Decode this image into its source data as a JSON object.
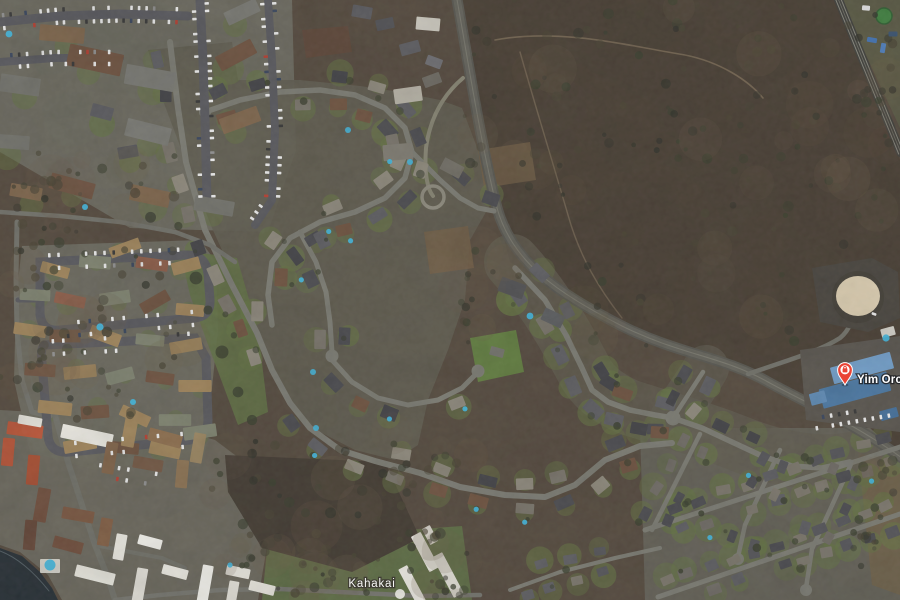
{
  "map": {
    "view_type": "satellite",
    "labels": [
      {
        "id": "road-label",
        "kind": "road",
        "text": "Kahakai"
      },
      {
        "id": "poi-label",
        "kind": "poi",
        "text": "Yim Orch"
      }
    ],
    "poi_pin": {
      "color": "#EA4335",
      "category_icon": "shopping-bag"
    },
    "colors": {
      "scrub_base": "#51463a",
      "scrub_dark": "#453b30",
      "scrub_south": "#3f372e",
      "residential_base": "#5c594c",
      "complex_base": "#67655a",
      "grid_base": "#5f5c52",
      "green_strip": "#5c6b40",
      "green_south": "#5a6941",
      "lawn": "#61713f",
      "field": "#6a5d46",
      "ocean": "#232b31",
      "road": "#78786f",
      "road_dark": "#55555a",
      "highway": "#54534c",
      "highway_inner": "#605f57",
      "highway_median": "#7a796e",
      "divided_road": "#3c3c37",
      "trail": "#85755c",
      "pool": "#3fb2d8",
      "tank": "#d9cbae",
      "tank_pad": "#45413a",
      "tree": "#363b2a",
      "dirt": "#6f5b42",
      "car_white": "#e9e9e9",
      "roof_dark": "#47474b",
      "roof_gray": "#5a5a5e",
      "roof_brown": "#6b4f3c",
      "roof_tan": "#9c8157",
      "roof_red": "#b35033",
      "roof_white": "#e6e4dc",
      "roof_blue": "#47749f",
      "roof_blue_light": "#6e9bc6"
    }
  }
}
